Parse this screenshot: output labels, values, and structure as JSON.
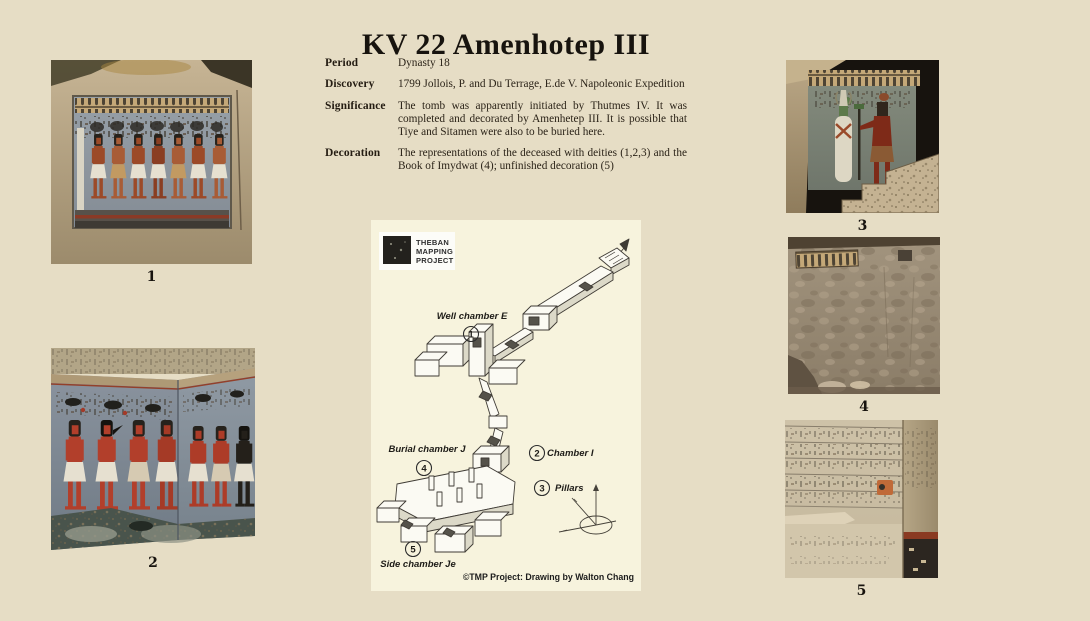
{
  "page": {
    "title": "KV 22 Amenhotep III",
    "background": "#e6ddc5"
  },
  "info": {
    "rows": [
      {
        "label": "Period",
        "value": "Dynasty 18"
      },
      {
        "label": "Discovery",
        "value": "1799 Jollois, P. and Du Terrage, E.de V. Napoleonic Expedition"
      },
      {
        "label": "Significance",
        "value": "The tomb was apparently initiated by Thutmes IV. It was completed and decorated by Amenhetep III. It is possible that Tiye and Sitamen were also to be buried here."
      },
      {
        "label": "Decoration",
        "value": "The representations of the deceased with deities (1,2,3) and the Book of Imydwat (4); unfinished decoration (5)"
      }
    ]
  },
  "map": {
    "background": "#f7f3dd",
    "logo": {
      "line1": "THEBAN",
      "line2": "MAPPING",
      "line3": "PROJECT"
    },
    "callouts": [
      {
        "num": "1",
        "label": "Well chamber E"
      },
      {
        "num": "2",
        "label": "Chamber I"
      },
      {
        "num": "3",
        "label": "Pillars"
      },
      {
        "num": "4",
        "label": "Burial chamber J"
      },
      {
        "num": "5",
        "label": "Side chamber Je"
      }
    ],
    "caption": "©TMP Project: Drawing by Walton Chang"
  },
  "photos": [
    {
      "label": "1"
    },
    {
      "label": "2"
    },
    {
      "label": "3"
    },
    {
      "label": "4"
    },
    {
      "label": "5"
    }
  ]
}
